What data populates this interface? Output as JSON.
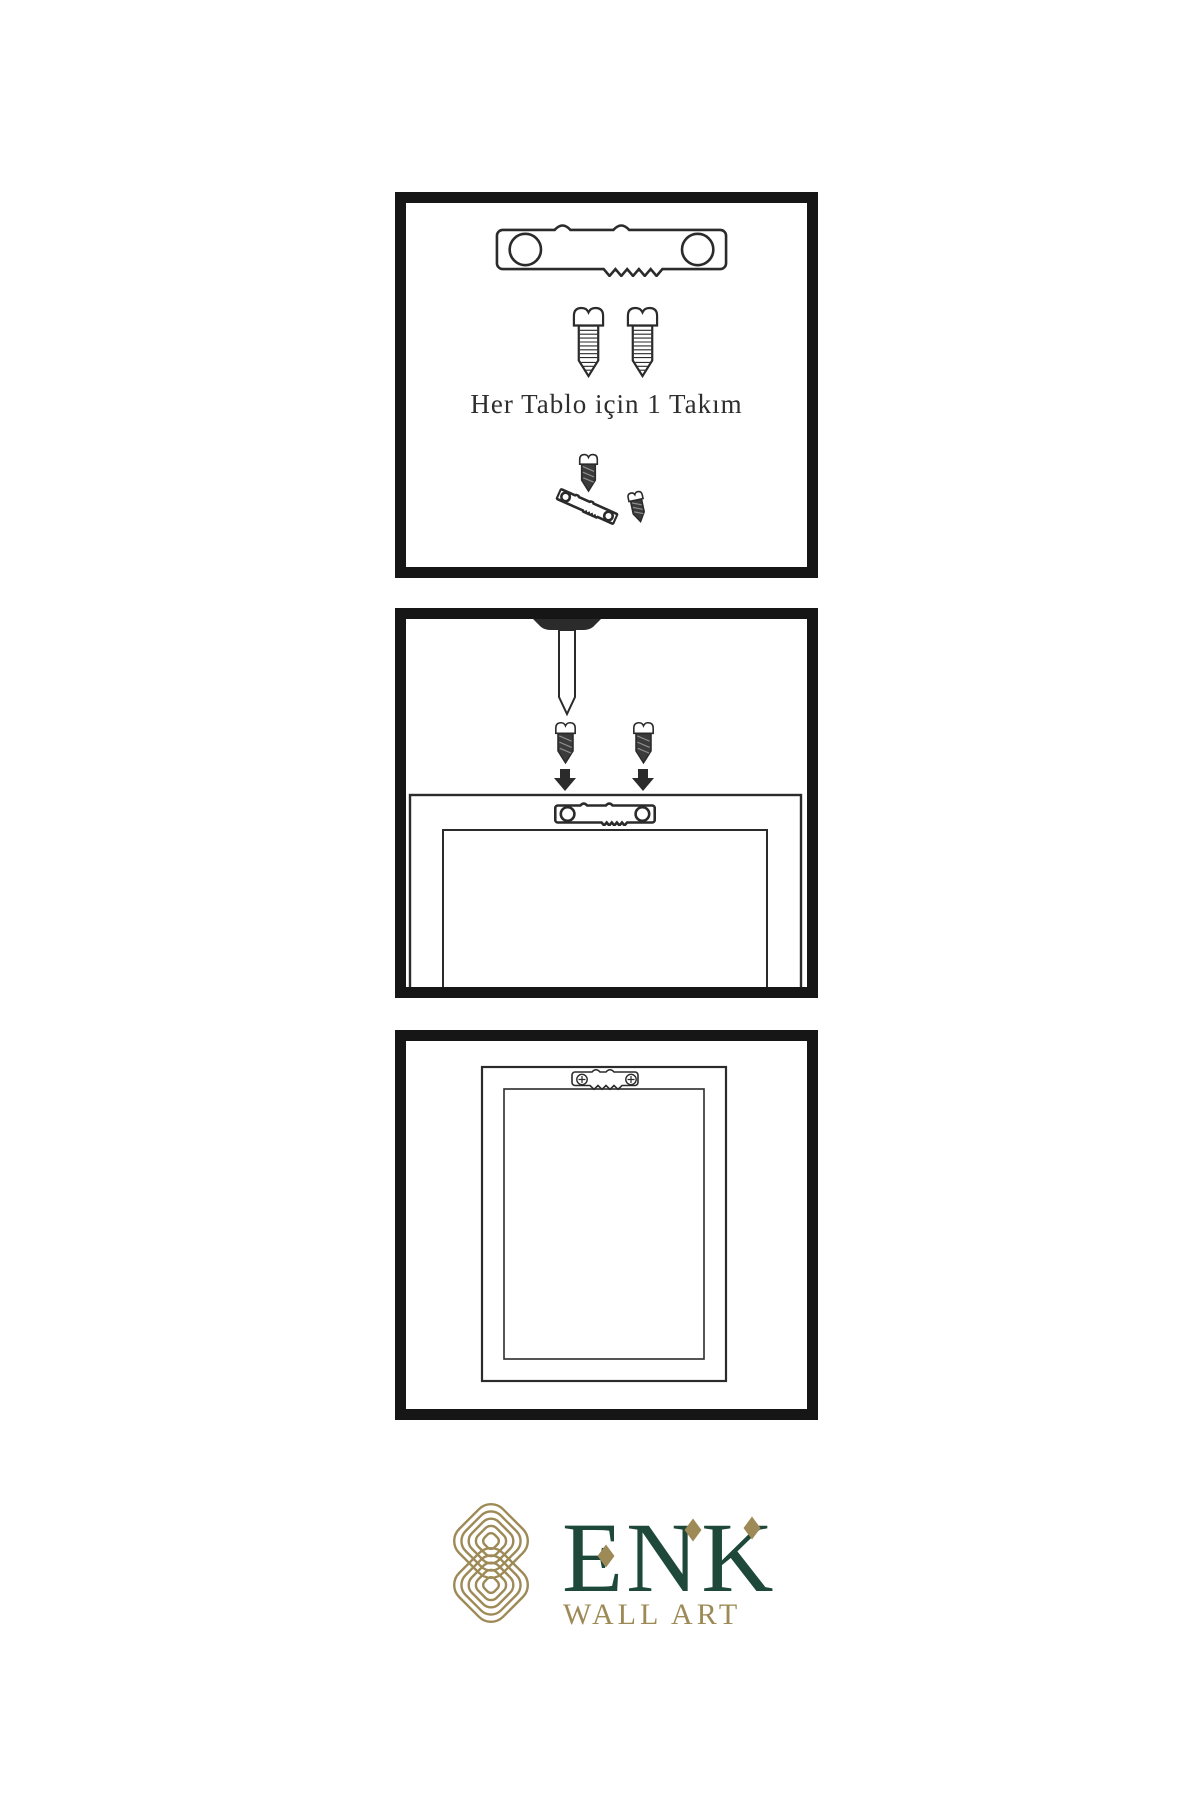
{
  "colors": {
    "panel-border": "#161616",
    "ink": "#2b2b2b",
    "caption": "#2e2e2e",
    "gold": "#9d8a56",
    "green": "#1e4839"
  },
  "panel1": {
    "caption": "Her Tablo için 1 Takım"
  },
  "logo": {
    "brand": "ENK",
    "tagline": "WALL ART"
  },
  "icons": {
    "hanger": "sawtooth-hanger-icon",
    "screw_light": "screw-icon",
    "screw_dark": "screw-dark-icon",
    "nail": "nail-icon",
    "arrow": "arrow-down-icon",
    "frame": "picture-frame-back-icon",
    "knot": "brand-knot-icon",
    "diamond": "diamond-accent-icon"
  }
}
